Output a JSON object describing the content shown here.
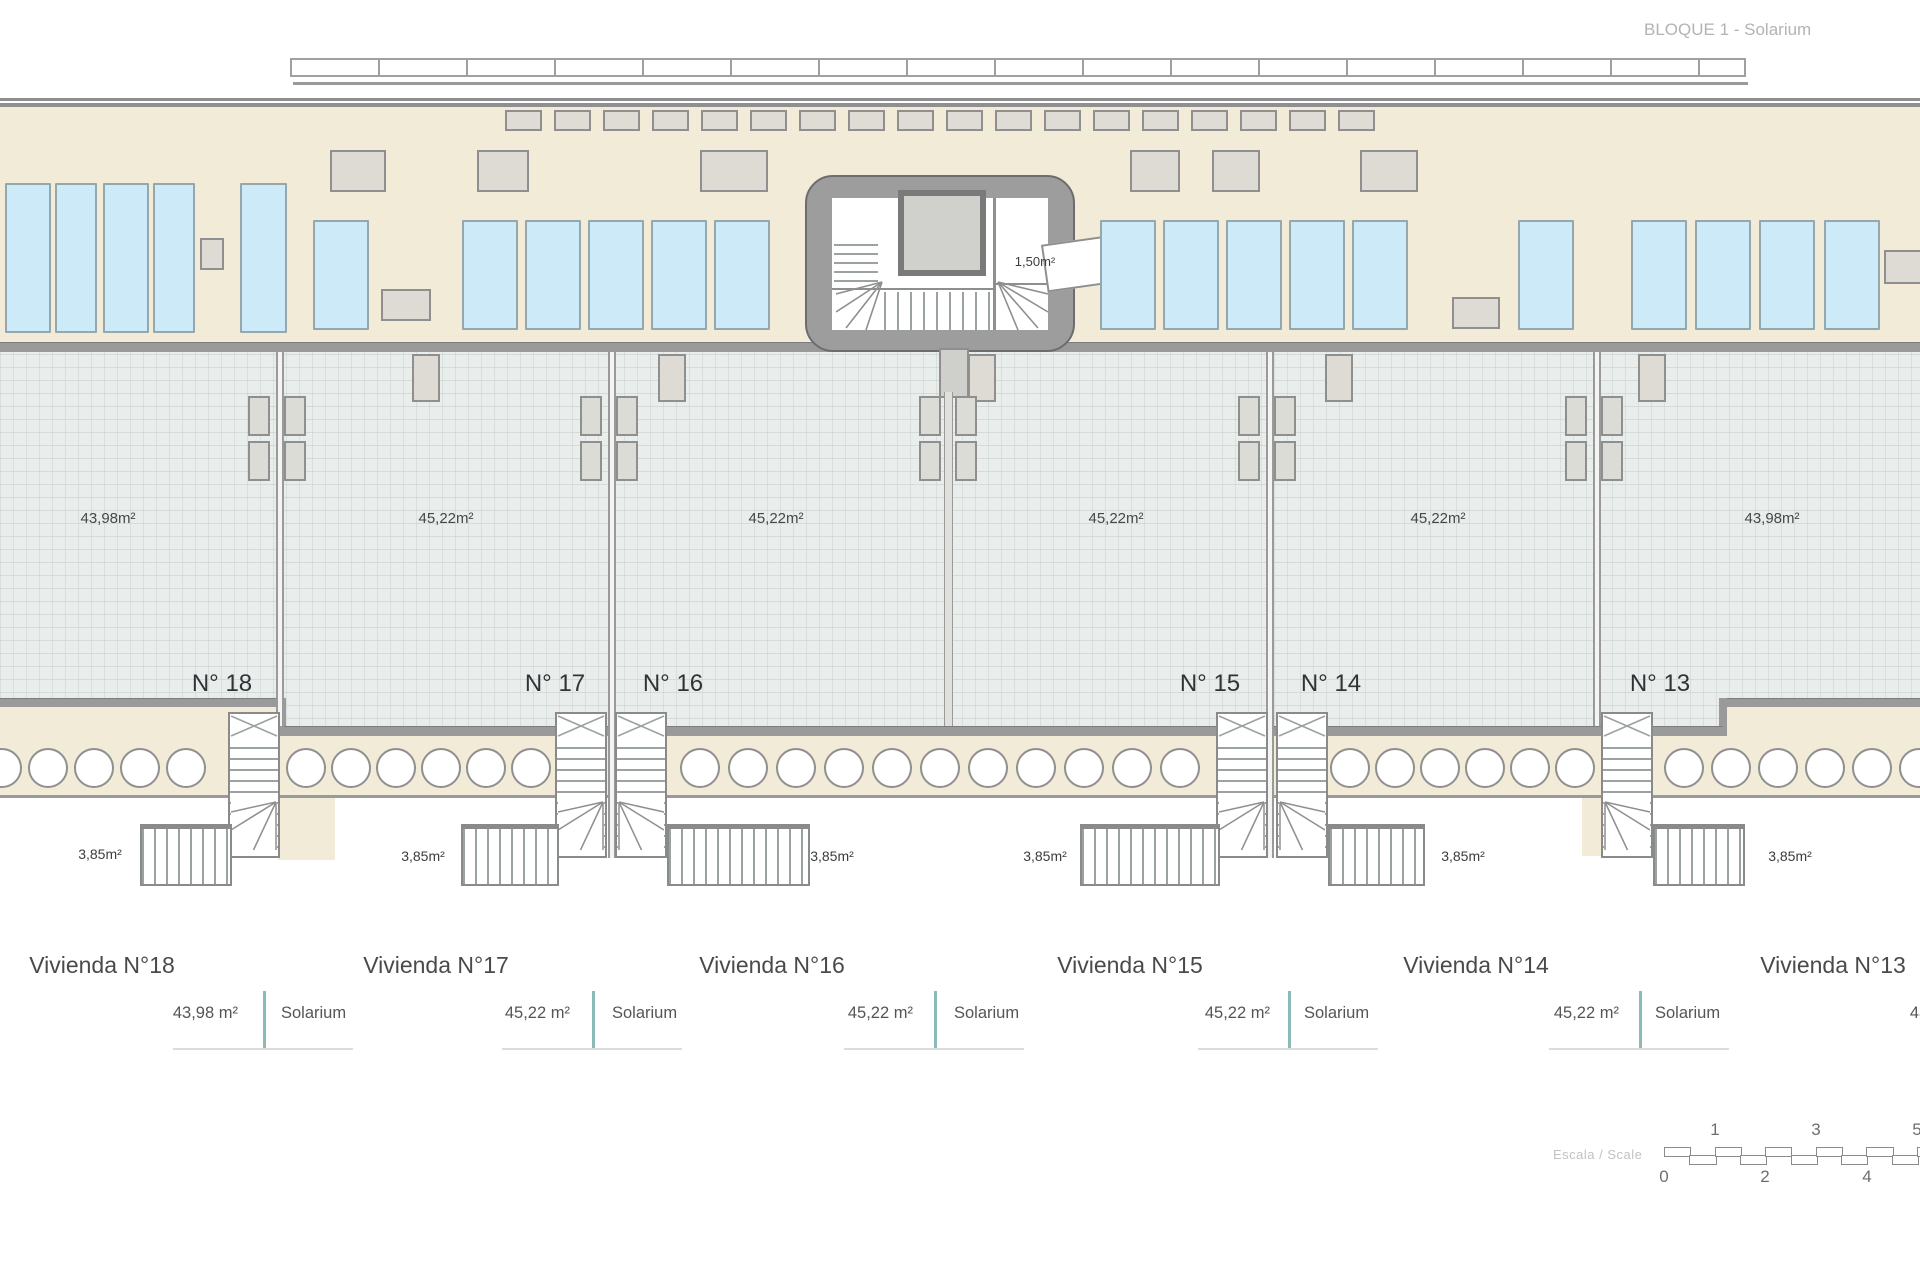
{
  "header": {
    "title": "BLOQUE 1 - Solarium"
  },
  "plan": {
    "stairwell": {
      "area_label": "1,50m²"
    },
    "units": [
      {
        "id": "18",
        "number_label": "N° 18",
        "area_label": "43,98m²",
        "stair_area_label": "3,85m²"
      },
      {
        "id": "17",
        "number_label": "N° 17",
        "area_label": "45,22m²",
        "stair_area_label": "3,85m²"
      },
      {
        "id": "16",
        "number_label": "N° 16",
        "area_label": "45,22m²",
        "stair_area_label": "3,85m²"
      },
      {
        "id": "15",
        "number_label": "N° 15",
        "area_label": "45,22m²",
        "stair_area_label": "3,85m²"
      },
      {
        "id": "14",
        "number_label": "N° 14",
        "area_label": "45,22m²",
        "stair_area_label": "3,85m²"
      },
      {
        "id": "13",
        "number_label": "N° 13",
        "area_label": "43,98m²",
        "stair_area_label": "3,85m²"
      }
    ]
  },
  "legend": {
    "blocks": [
      {
        "title": "Vivienda N°18",
        "room_label": "Solarium",
        "area": "43,98 m²"
      },
      {
        "title": "Vivienda N°17",
        "room_label": "Solarium",
        "area": "45,22 m²"
      },
      {
        "title": "Vivienda N°16",
        "room_label": "Solarium",
        "area": "45,22 m²"
      },
      {
        "title": "Vivienda N°15",
        "room_label": "Solarium",
        "area": "45,22 m²"
      },
      {
        "title": "Vivienda N°14",
        "room_label": "Solarium",
        "area": "45,22 m²"
      },
      {
        "title": "Vivienda N°13",
        "room_label": "Solarium",
        "area": "43,98 m²"
      }
    ]
  },
  "scale_bar": {
    "label": "Escala / Scale",
    "top_numbers": [
      "1",
      "3",
      "5"
    ],
    "bottom_numbers": [
      "0",
      "2",
      "4"
    ]
  },
  "colors": {
    "terrace_beige": "#f2ebd7",
    "sunbed_blue": "#cdeaf8",
    "tile_gray": "#e9edeb",
    "wall_gray": "#9a9a9a",
    "teal_divider": "#8cbab7"
  }
}
